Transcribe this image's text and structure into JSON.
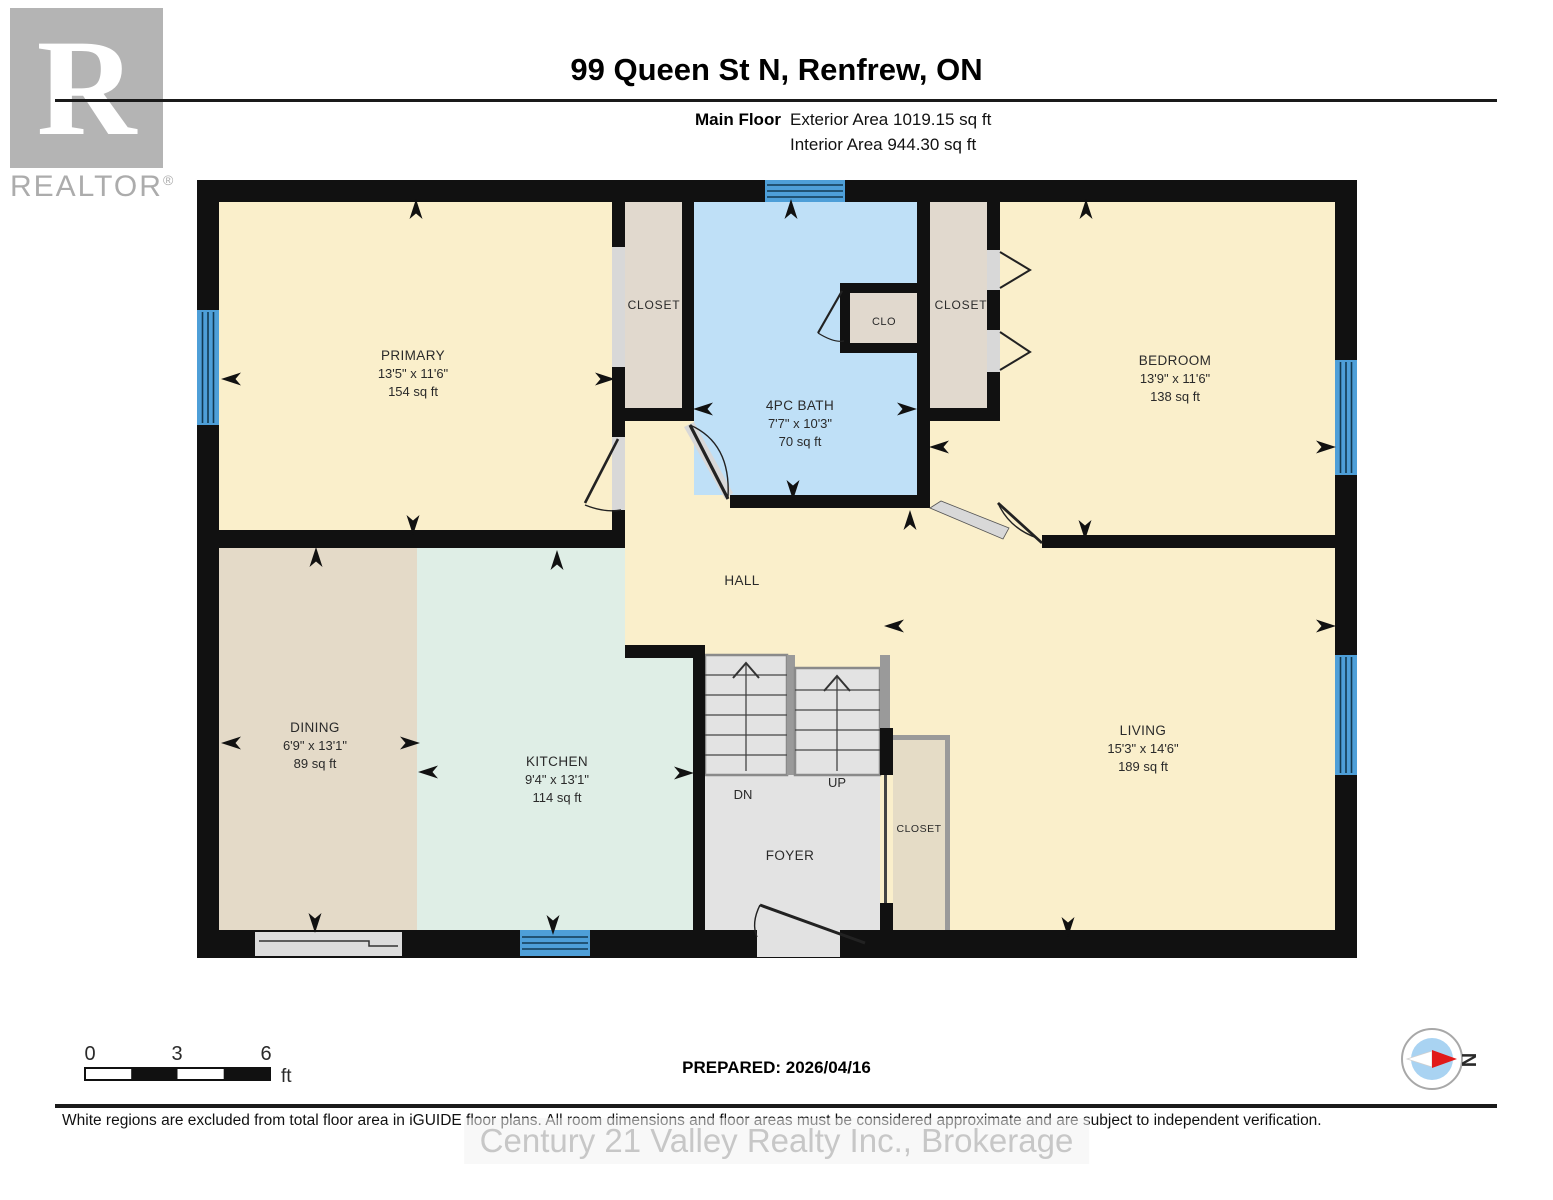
{
  "header": {
    "logo_letter": "R",
    "logo_brand": "REALTOR",
    "logo_reg": "®",
    "title": "99 Queen St N, Renfrew, ON",
    "floor_label": "Main Floor",
    "exterior_area": "Exterior Area 1019.15 sq ft",
    "interior_area": "Interior Area 944.30 sq ft"
  },
  "rooms": {
    "primary": {
      "name": "PRIMARY",
      "dims": "13'5\" x 11'6\"",
      "area": "154 sq ft"
    },
    "bath": {
      "name": "4PC BATH",
      "dims": "7'7\" x 10'3\"",
      "area": "70 sq ft"
    },
    "bedroom": {
      "name": "BEDROOM",
      "dims": "13'9\" x 11'6\"",
      "area": "138 sq ft"
    },
    "dining": {
      "name": "DINING",
      "dims": "6'9\" x 13'1\"",
      "area": "89 sq ft"
    },
    "kitchen": {
      "name": "KITCHEN",
      "dims": "9'4\" x 13'1\"",
      "area": "114 sq ft"
    },
    "living": {
      "name": "LIVING",
      "dims": "15'3\" x 14'6\"",
      "area": "189 sq ft"
    },
    "hall": {
      "name": "HALL"
    },
    "foyer": {
      "name": "FOYER"
    },
    "closet_primary": {
      "name": "CLOSET"
    },
    "closet_bedroom": {
      "name": "CLOSET"
    },
    "clo": {
      "name": "CLO"
    },
    "closet_foyer": {
      "name": "CLOSET"
    },
    "stairs": {
      "dn": "DN",
      "up": "UP"
    }
  },
  "scale_bar": {
    "tick0": "0",
    "tick3": "3",
    "tick6": "6",
    "unit": "ft"
  },
  "prepared_label": "PREPARED: 2026/04/16",
  "compass": {
    "north_label": "N"
  },
  "disclaimer": "White regions are excluded from total floor area in iGUIDE floor plans. All room dimensions and floor areas must be considered approximate and are subject to independent verification.",
  "watermark": "Century 21 Valley Realty Inc., Brokerage",
  "colors": {
    "wall": "#111111",
    "room_cream": "#FAEFCB",
    "closet_beige": "#E1D9CE",
    "foyer_closet_beige": "#E5DCC6",
    "bath_blue": "#BFE0F7",
    "dining_tan": "#E4DAC8",
    "kitchen_mint": "#DFEEE6",
    "stairs_gray": "#E3E3E3",
    "window_blue": "#4E9FD8",
    "compass_red": "#E11A1A",
    "compass_blue": "#A9D3F2"
  }
}
